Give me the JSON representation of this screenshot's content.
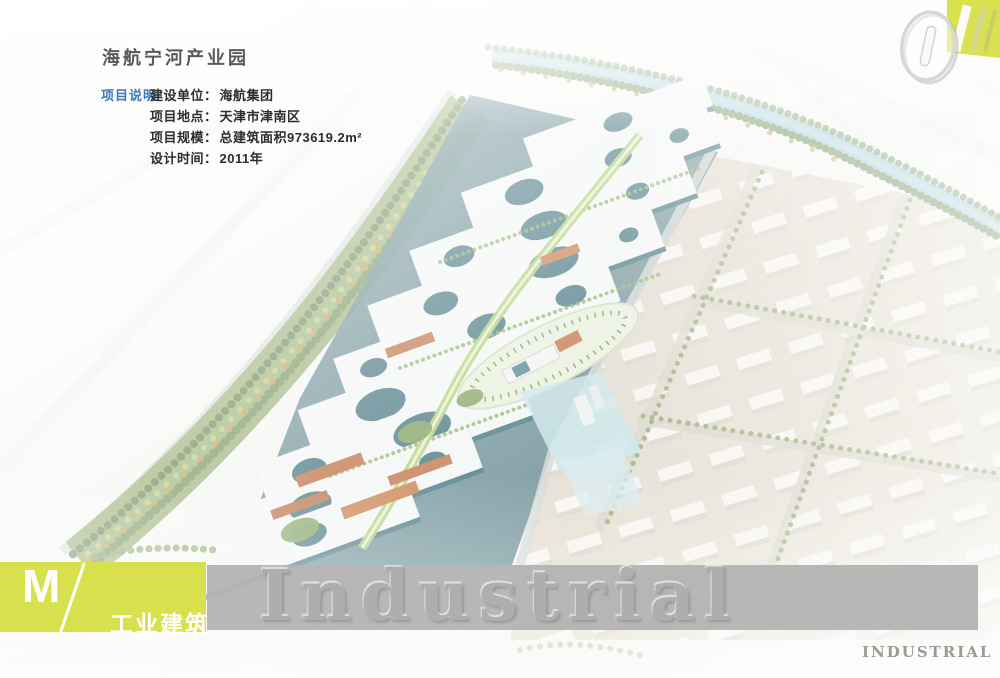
{
  "header": {
    "title": "海航宁河产业园"
  },
  "project_info": {
    "section_label": "项目说明",
    "items": [
      {
        "label": "建设单位：",
        "value": "海航集团"
      },
      {
        "label": "项目地点：",
        "value": "天津市津南区"
      },
      {
        "label": "项目规模：",
        "value": "总建筑面积973619.2m²"
      },
      {
        "label": "设计时间：",
        "value": "2011年"
      }
    ]
  },
  "page_number": "01",
  "footer": {
    "category_letter": "M",
    "category_label": "工业建筑",
    "watermark": "Industrial",
    "corner_label": "INDUSTRIAL"
  },
  "colors": {
    "accent_yellow": "#d9e14f",
    "label_blue": "#3b7abf",
    "banner_gray": "#b3b3b3",
    "render_teal": "#3a7582",
    "render_green": "#7f9c52",
    "render_beige": "#ddd6c8",
    "river_blue": "#8cc0c9",
    "roof_white": "#f3f5f4",
    "orange_accent": "#b86230"
  }
}
